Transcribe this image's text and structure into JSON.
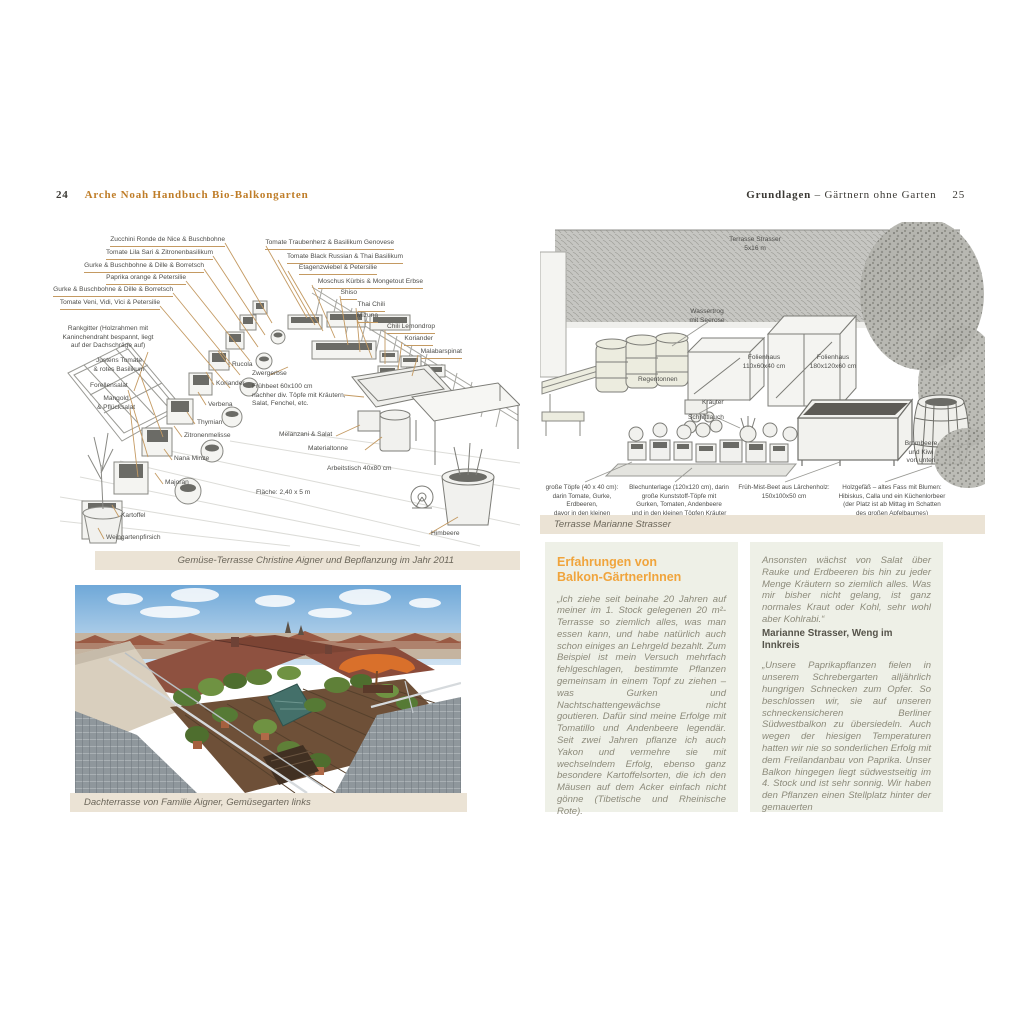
{
  "page_left": {
    "page_number": "24",
    "title": "Arche Noah Handbuch Bio-Balkongarten",
    "illustration": {
      "left_labels": [
        "Zucchini Ronde de Nice & Buschbohne",
        "Tomate Lila Sari & Zitronenbasilikum",
        "Gurke & Buschbohne & Dille & Borretsch",
        "Paprika orange & Petersilie",
        "Gurke & Buschbohne & Dille & Borretsch",
        "Tomate Veni, Vidi, Vici & Petersilie"
      ],
      "right_labels": [
        "Tomate Traubenherz & Basilikum Genovese",
        "Tomate Black Russian & Thai Basilikum",
        "Etagenzwiebel & Petersilie",
        "Moschus Kürbis & Mongetout Erbse",
        "Shiso",
        "Thai Chili",
        "Mizuna",
        "Chili Lemondrop",
        "Koriander",
        "Malabarspinat"
      ],
      "free_labels": [
        "Rankgitter (Holzrahmen mit\nKaninchendraht bespannt, liegt\nauf der Dachschräge auf)",
        "Justens Tomate\n& rotes Basilikum",
        "Forellensalat",
        "Mangold\n& Pflücksalat",
        "Rucola",
        "Zwergerbse",
        "Koriander",
        "Frühbeet 60x100 cm\nnachher div. Töpfe mit Kräutern,\nSalat, Fenchel, etc.",
        "Verbena",
        "Thymian",
        "Zitronenmelisse",
        "Nana Minze",
        "Majoran",
        "Kartoffel",
        "Weingartenpfirsich",
        "Melanzani & Salat",
        "Materialtonne",
        "Arbeitstisch 40x80 cm",
        "Fläche: 2,40 x 5 m",
        "Himbeere"
      ],
      "caption": "Gemüse-Terrasse Christine Aigner und Bepflanzung im Jahr 2011"
    },
    "photo": {
      "caption": "Dachterrasse von Familie Aigner, Gemüsegarten links"
    }
  },
  "page_right": {
    "header_section": "Grundlagen",
    "header_chapter": " – Gärtnern ohne Garten",
    "page_number": "25",
    "illustration": {
      "labels": [
        "Terrasse Strasser\n5x16 m",
        "Wassertrog\nmit Seerose",
        "Regentonnen",
        "Kräuter",
        "Folienhaus\n110x60x40 cm",
        "Folienhaus\n180x120x60 cm",
        "Schnittlauch",
        "Brombeere\nund Kiwi\nvon unten"
      ],
      "footnotes": [
        "große Töpfe (40 x 40 cm):\ndarin Tomate, Gurke, Erdbeeren,\ndavor in den kleinen\nTöpfen Kräuter",
        "Blechunterlage (120x120 cm), darin\ngroße Kunststoff-Töpfe mit\nGurken, Tomaten, Andenbeere\nund in den kleinen Töpfen Kräuter „aller Art“",
        "Früh-Mist-Beet aus Lärchenholz:\n150x100x50 cm",
        "Holzgefäß – altes Fass mit Blumen:\nHibiskus, Calla und ein Küchenlorbeer\n(der Platz ist ab Mittag im Schatten\ndes großen Apfelbaumes)"
      ],
      "caption": "Terrasse Marianne Strasser"
    },
    "experiences": {
      "heading": "Erfahrungen von\nBalkon-GärtnerInnen",
      "quote1": "„Ich ziehe seit beinahe 20 Jahren auf meiner im 1. Stock gelegenen 20 m²-Terrasse so ziemlich alles, was man essen kann, und habe natürlich auch schon einiges an Lehrgeld bezahlt. Zum Beispiel ist mein Versuch mehrfach fehlgeschlagen, bestimmte Pflanzen gemeinsam in einem Topf zu ziehen – was Gurken und Nachtschattengewächse nicht goutieren. Dafür sind meine Erfolge mit Tomatillo und Andenbeere legendär. Seit zwei Jahren pflanze ich auch Yakon und vermehre sie mit wechselndem Erfolg, ebenso ganz besondere Kartoffelsorten, die ich den Mäusen auf dem Acker einfach nicht gönne (Tibetische und Rheinische Rote).",
      "quote1_end": "Ansonsten wächst von Salat über Rauke und Erdbeeren bis hin zu jeder Menge Kräutern so ziemlich alles. Was mir bisher nicht gelang, ist ganz normales Kraut oder Kohl, sehr wohl aber Kohlrabi.“",
      "attribution": "Marianne Strasser, Weng im Innkreis",
      "quote2": "„Unsere Paprikapflanzen fielen in unserem Schrebergarten alljährlich hungrigen Schnecken zum Opfer. So beschlossen wir, sie auf unseren schneckensicheren Berliner Südwestbalkon zu übersiedeln. Auch wegen der hiesigen Temperaturen hatten wir nie so sonderlichen Erfolg mit dem Freilandanbau von Paprika. Unser Balkon hingegen liegt südwestseitig im 4. Stock und ist sehr sonnig. Wir haben den Pflanzen einen Stellplatz hinter der gemauerten"
    }
  },
  "colors": {
    "accent_orange": "#bf7d28",
    "heading_orange": "#f0a43c",
    "caption_bg": "#ebe3d5",
    "box_bg": "#eef0e7",
    "leader_line": "#c49a62"
  }
}
